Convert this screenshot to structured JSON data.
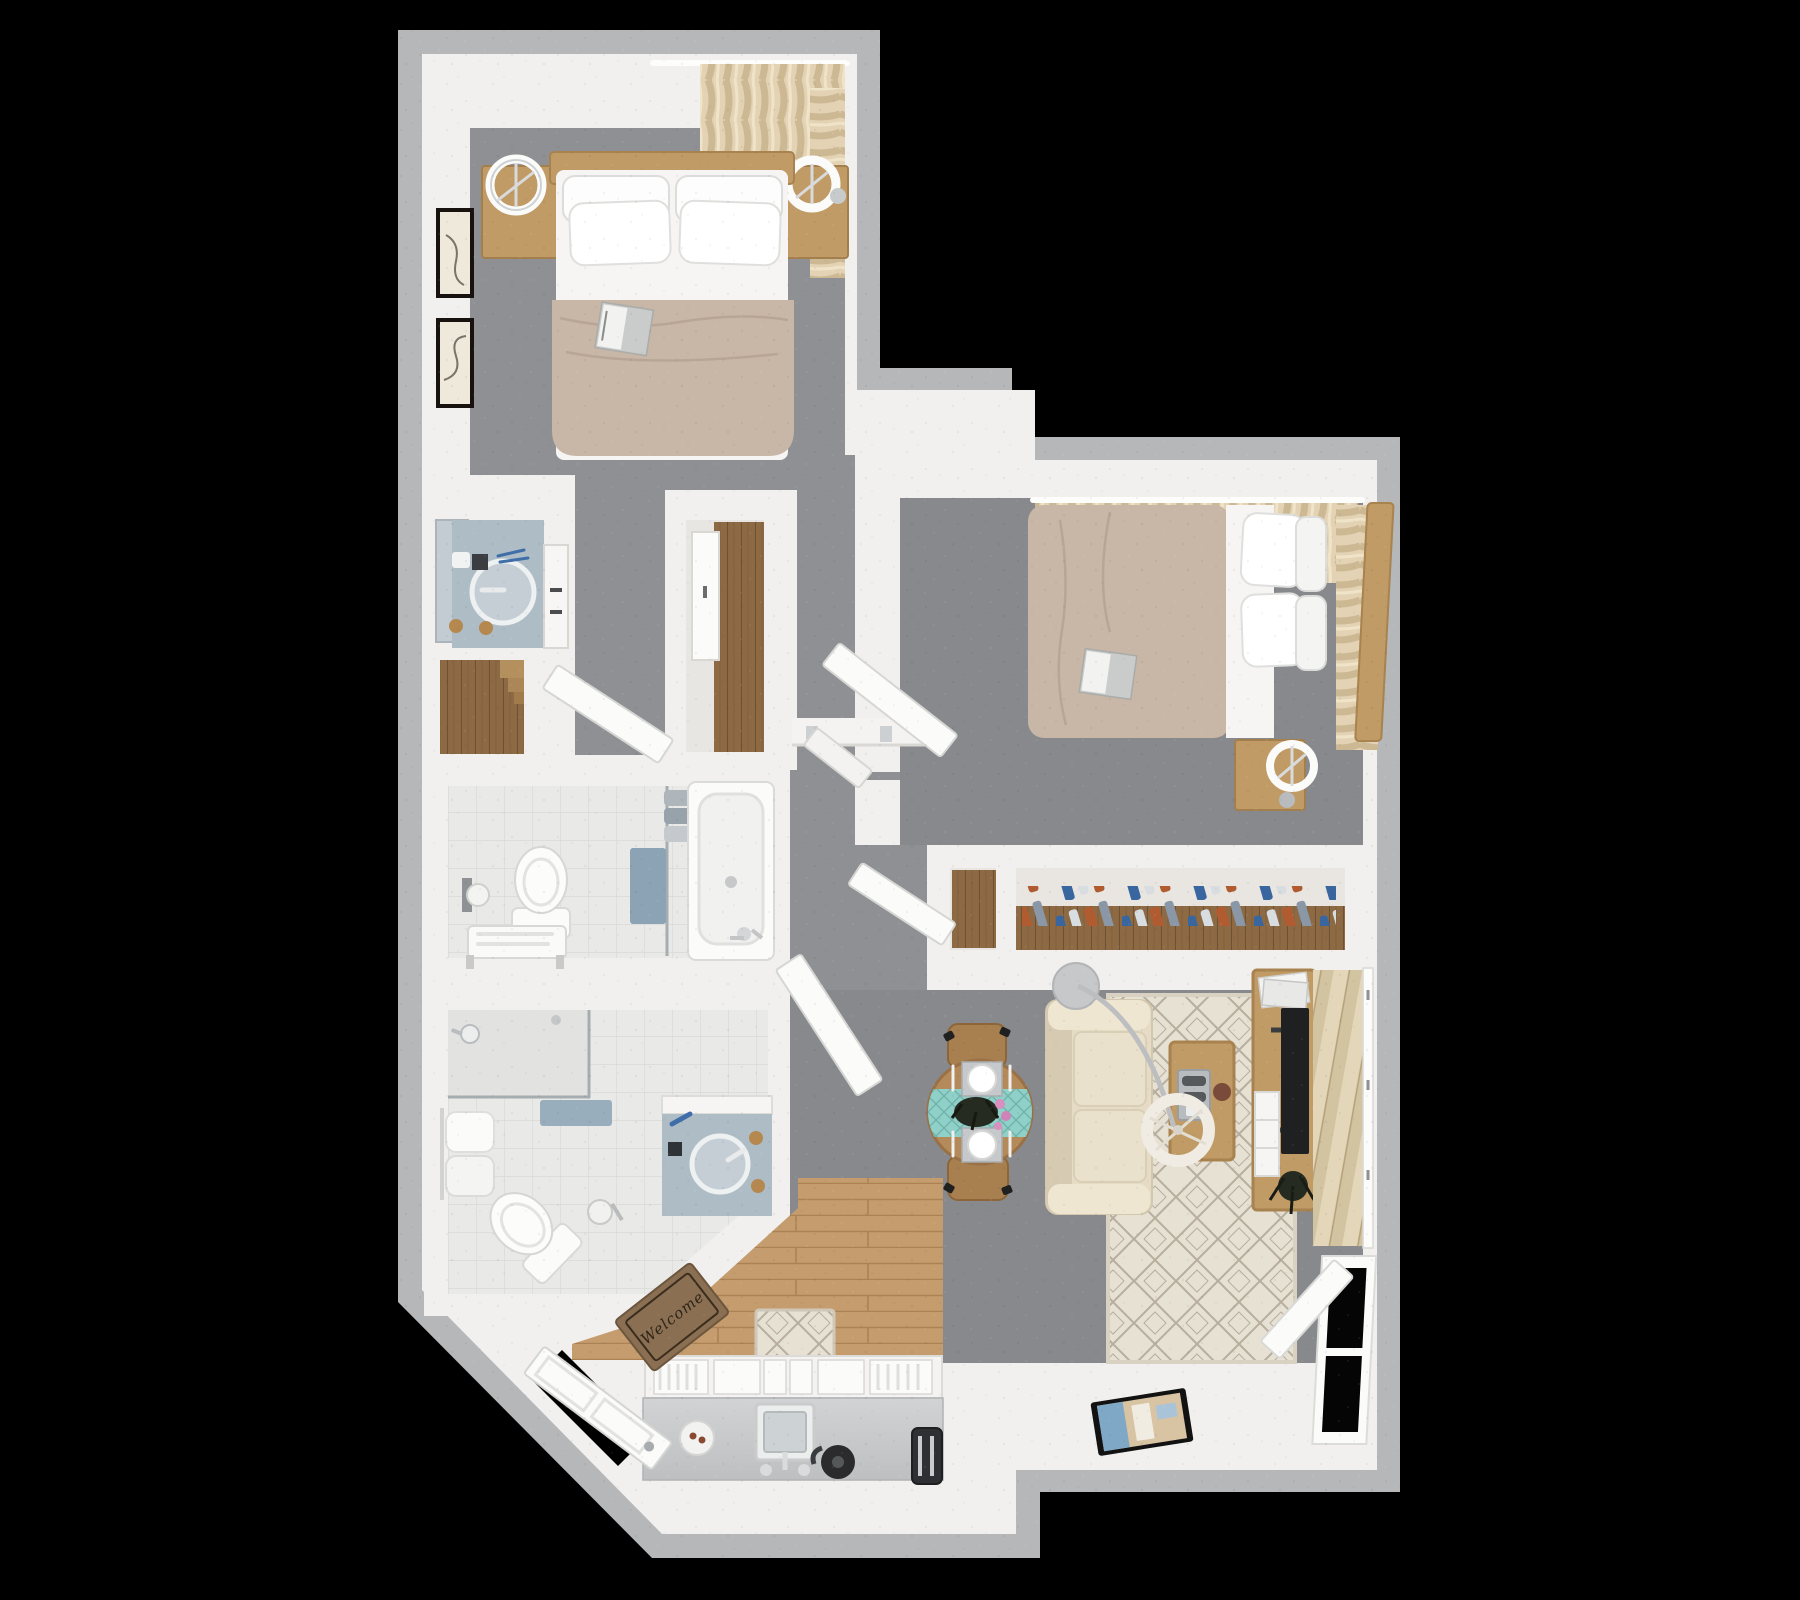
{
  "scene": {
    "type": "3d-floorplan-top-down-render",
    "description": "Photorealistic top-down 3D floor plan of a two-bedroom, two-bathroom apartment on a black background",
    "background": "#000000"
  },
  "entry": {
    "doormat_text": "Welcome"
  },
  "colors": {
    "bg": "#000000",
    "outer_wall": "#b5b7b9",
    "wall": "#f1f0ee",
    "carpet": "#8e9093",
    "carpet_dark": "#87898c",
    "tile": "#e9e9e7",
    "tile_line": "#d9d9d7",
    "wood_floor": "#c59c6d",
    "wood_floor_line": "#ac8254",
    "wood_furniture": "#c19b66",
    "wood_dark": "#8d6a44",
    "duvet": "#c8b6a7",
    "sheet": "#f6f5f3",
    "curtain_a": "#e3d3b4",
    "curtain_b": "#ccb993",
    "sofa": "#e6dcc6",
    "sofa_dark": "#d6cbb2",
    "rug": "#e7e1d4",
    "rug_line": "#b7ae9e",
    "teal": "#8fd0c8",
    "teal_dark": "#6fb2a9",
    "marble": "#aebcc6",
    "fixture": "#fafaf9",
    "towel_blue": "#8ba3b5",
    "mat_brown": "#8a6f52",
    "tv": "#1e2022",
    "metal": "#c2c5c7",
    "plant": "#262b21",
    "blind_a": "#e4d7b9",
    "blind_b": "#d2c3a1",
    "clothes_blue": "#3a66a0",
    "clothes_rust": "#b05c30",
    "clothes_light": "#d8dde1",
    "clothes_gray": "#8a97a6"
  },
  "rooms": [
    {
      "id": "bedroom-1",
      "furniture": [
        "double-bed",
        "nightstand-left",
        "nightstand-right",
        "ring-lamp-left",
        "ring-lamp-right",
        "wall-art-frames",
        "corner-curtains",
        "magazine-on-bed"
      ]
    },
    {
      "id": "vanity-nook",
      "furniture": [
        "marble-counter",
        "round-sink",
        "mirror",
        "side-cabinet",
        "wood-dresser"
      ]
    },
    {
      "id": "hall-closet",
      "furniture": [
        "sliding-door",
        "wood-closet-floor"
      ]
    },
    {
      "id": "bathroom-1",
      "furniture": [
        "toilet",
        "toilet-paper-holder",
        "towel-bench",
        "glass-partition",
        "hanging-blue-towel",
        "folded-towels",
        "bathtub"
      ]
    },
    {
      "id": "bathroom-2",
      "furniture": [
        "walk-in-shower",
        "shower-head",
        "bath-mat",
        "towel-rack",
        "angled-toilet",
        "toilet-paper-stand",
        "vanity-sink"
      ]
    },
    {
      "id": "bedroom-2",
      "furniture": [
        "double-bed",
        "headboard",
        "nightstand",
        "ring-lamp",
        "window-curtains",
        "magazine-on-bed",
        "entry-door"
      ]
    },
    {
      "id": "wardrobe-closet",
      "furniture": [
        "hanging-clothes",
        "wood-shelf",
        "closet-door"
      ]
    },
    {
      "id": "living-room",
      "furniture": [
        "sofa",
        "coffee-table",
        "game-controllers-tray",
        "arc-floor-lamp",
        "tv-console",
        "flat-tv",
        "magazines",
        "potted-plant",
        "area-rug",
        "vertical-blinds",
        "window",
        "tablet-on-ledge"
      ]
    },
    {
      "id": "dining-area",
      "furniture": [
        "round-table",
        "teal-runner",
        "place-settings",
        "centerpiece-plant",
        "dining-chairs"
      ]
    },
    {
      "id": "kitchen",
      "furniture": [
        "lower-cabinets",
        "countertop",
        "sink",
        "faucet",
        "kettle",
        "toaster",
        "plate",
        "runner-rug",
        "wood-floor"
      ]
    },
    {
      "id": "entry",
      "furniture": [
        "front-door",
        "welcome-mat"
      ]
    }
  ]
}
